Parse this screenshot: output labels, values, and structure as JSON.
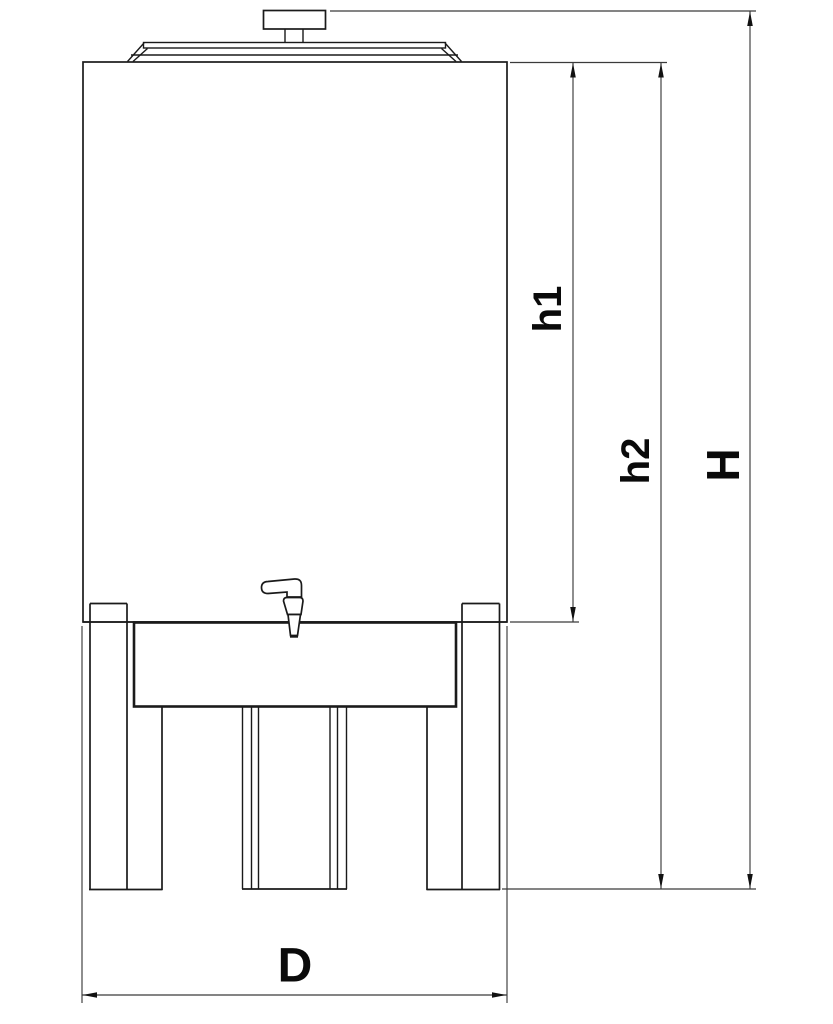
{
  "drawing": {
    "kind": "technical-dimension-drawing",
    "subject": "tank-front-elevation",
    "colors": {
      "background": "#ffffff",
      "drawing_line": "#1a1a1a",
      "dimension_line": "#3b3b3b",
      "arrow": "#111111",
      "label_text": "#0a0a0a"
    },
    "dimensions": {
      "h1": {
        "label": "h1"
      },
      "h2": {
        "label": "h2"
      },
      "H": {
        "label": "H"
      },
      "D": {
        "label": "D"
      }
    }
  }
}
